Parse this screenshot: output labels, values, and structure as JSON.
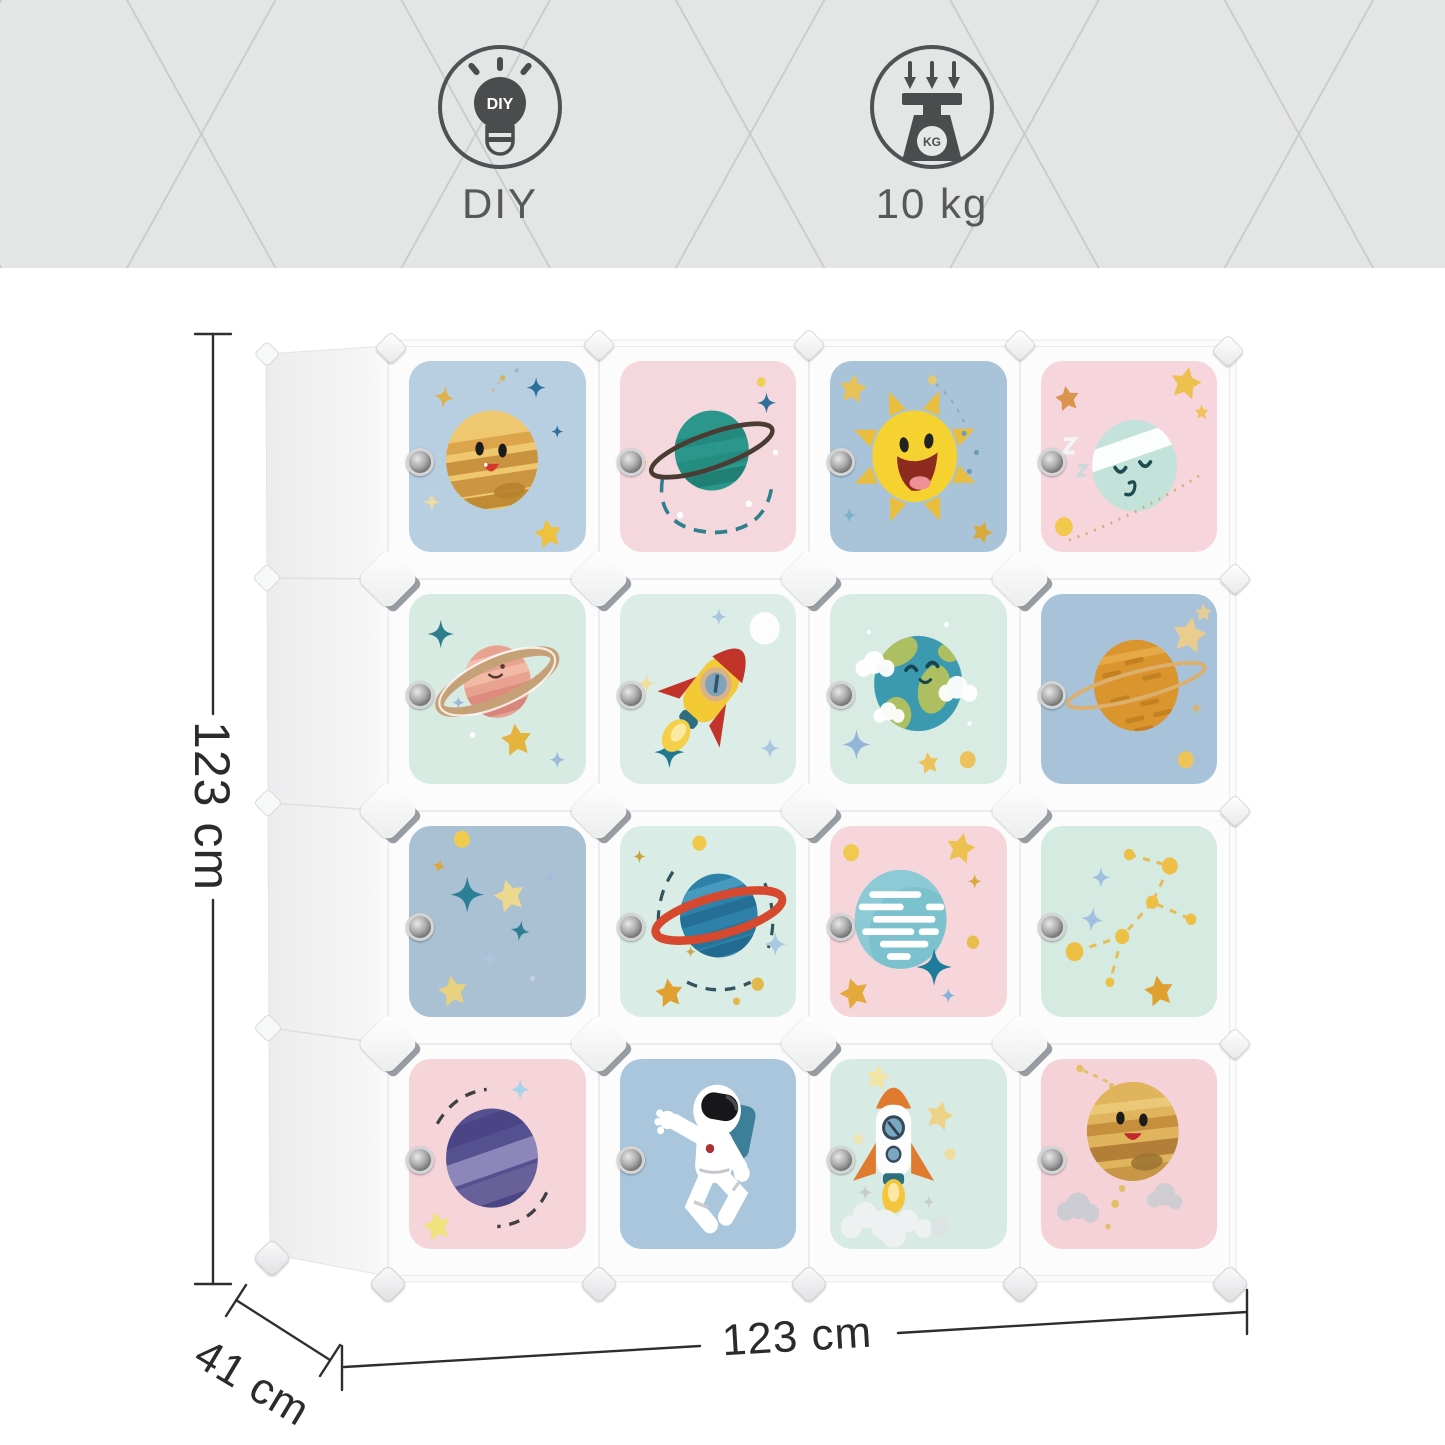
{
  "banner": {
    "background": "#e4e5e5",
    "features": [
      {
        "icon": "diy-lightbulb-icon",
        "icon_text": "DIY",
        "label": "DIY"
      },
      {
        "icon": "weight-scale-icon",
        "icon_text": "KG",
        "label": "10 kg"
      }
    ]
  },
  "dimensions": {
    "height": "123 cm",
    "width": "123 cm",
    "depth": "41 cm"
  },
  "wardrobe": {
    "rows": 4,
    "cols": 4,
    "cube_count": 16,
    "cubes": [
      {
        "r": 1,
        "c": 1,
        "motif": "jupiter-face",
        "bg": "#b7cfe1"
      },
      {
        "r": 1,
        "c": 2,
        "motif": "ringed-teal-planet",
        "bg": "#f5d8de"
      },
      {
        "r": 1,
        "c": 3,
        "motif": "happy-sun",
        "bg": "#a9c3d9"
      },
      {
        "r": 1,
        "c": 4,
        "motif": "sleeping-planet",
        "bg": "#f6d5dd"
      },
      {
        "r": 2,
        "c": 1,
        "motif": "smiling-saturn",
        "bg": "#d8ebe2"
      },
      {
        "r": 2,
        "c": 2,
        "motif": "flying-rocket",
        "bg": "#dcece6"
      },
      {
        "r": 2,
        "c": 3,
        "motif": "happy-earth",
        "bg": "#d9ece4"
      },
      {
        "r": 2,
        "c": 4,
        "motif": "orange-ringed-planet",
        "bg": "#a8c3d9"
      },
      {
        "r": 3,
        "c": 1,
        "motif": "star-field",
        "bg": "#aac1d4"
      },
      {
        "r": 3,
        "c": 2,
        "motif": "blue-planet-red-ring",
        "bg": "#d9ece5"
      },
      {
        "r": 3,
        "c": 3,
        "motif": "streaked-planet",
        "bg": "#f6d6da"
      },
      {
        "r": 3,
        "c": 4,
        "motif": "constellation",
        "bg": "#d5eae1"
      },
      {
        "r": 4,
        "c": 1,
        "motif": "purple-planet",
        "bg": "#f5d4da"
      },
      {
        "r": 4,
        "c": 2,
        "motif": "astronaut",
        "bg": "#a9c6dd"
      },
      {
        "r": 4,
        "c": 3,
        "motif": "launching-rocket",
        "bg": "#d7eae3"
      },
      {
        "r": 4,
        "c": 4,
        "motif": "smiling-jupiter",
        "bg": "#f4d2d8"
      }
    ]
  }
}
